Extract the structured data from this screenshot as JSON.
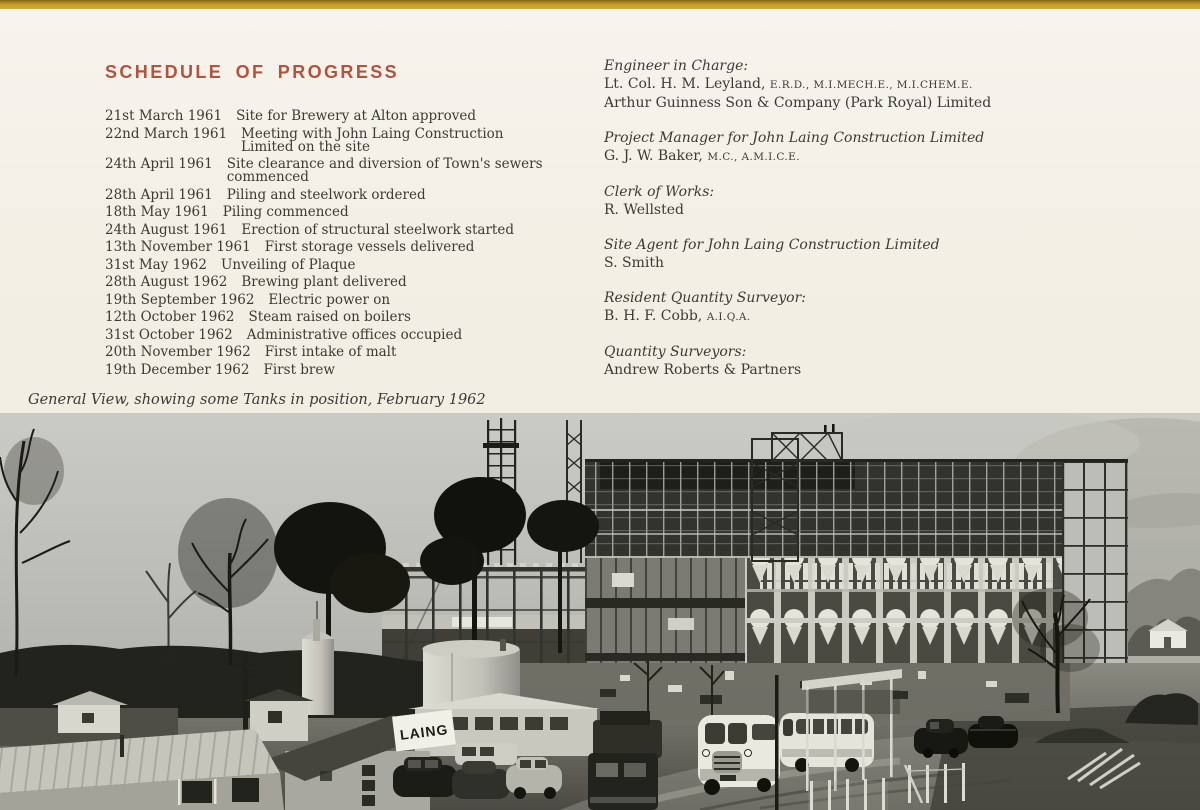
{
  "page": {
    "background": "#f2efe5",
    "top_strip_color": "#c7a02c"
  },
  "schedule": {
    "title": "SCHEDULE OF PROGRESS",
    "title_color": "#b0543e",
    "entries": [
      {
        "date": "21st March 1961",
        "event": "Site for Brewery at Alton approved"
      },
      {
        "date": "22nd March 1961",
        "event": "Meeting with John Laing Construction Limited on the site"
      },
      {
        "date": "24th April 1961",
        "event": "Site clearance and diversion of Town's sewers commenced"
      },
      {
        "date": "28th April 1961",
        "event": "Piling and steelwork ordered"
      },
      {
        "date": "18th May 1961",
        "event": "Piling commenced"
      },
      {
        "date": "24th August 1961",
        "event": "Erection of structural steelwork started"
      },
      {
        "date": "13th November 1961",
        "event": "First storage vessels delivered"
      },
      {
        "date": "31st May 1962",
        "event": "Unveiling of Plaque"
      },
      {
        "date": "28th August 1962",
        "event": "Brewing plant delivered"
      },
      {
        "date": "19th September 1962",
        "event": "Electric power on"
      },
      {
        "date": "12th October 1962",
        "event": "Steam raised on boilers"
      },
      {
        "date": "31st October 1962",
        "event": "Administrative offices occupied"
      },
      {
        "date": "20th November 1962",
        "event": "First intake of malt"
      },
      {
        "date": "19th December 1962",
        "event": "First brew"
      }
    ]
  },
  "personnel": [
    {
      "role": "Engineer in Charge:",
      "line1": "Lt. Col. H. M. Leyland, ",
      "line1_caps": "E.R.D., M.I.MECH.E., M.I.CHEM.E.",
      "line2": "Arthur Guinness Son & Company (Park Royal) Limited"
    },
    {
      "role": "Project Manager for John Laing Construction Limited",
      "line1": "G. J. W. Baker, ",
      "line1_caps": "M.C., A.M.I.C.E."
    },
    {
      "role": "Clerk of Works:",
      "line1": "R. Wellsted"
    },
    {
      "role": "Site Agent for John Laing Construction Limited",
      "line1": "S. Smith"
    },
    {
      "role": "Resident Quantity Surveyor:",
      "line1": "B. H. F. Cobb, ",
      "line1_caps": "A.I.Q.A."
    },
    {
      "role": "Quantity Surveyors:",
      "line1": "Andrew Roberts & Partners"
    }
  ],
  "caption": "General View, showing some Tanks in position, February 1962",
  "photo": {
    "sign_text": "LAING",
    "description": "Black and white photograph of brewery construction site: steel-framed building with storage tanks, winter trees, site huts, coaches, cars and a silo"
  }
}
